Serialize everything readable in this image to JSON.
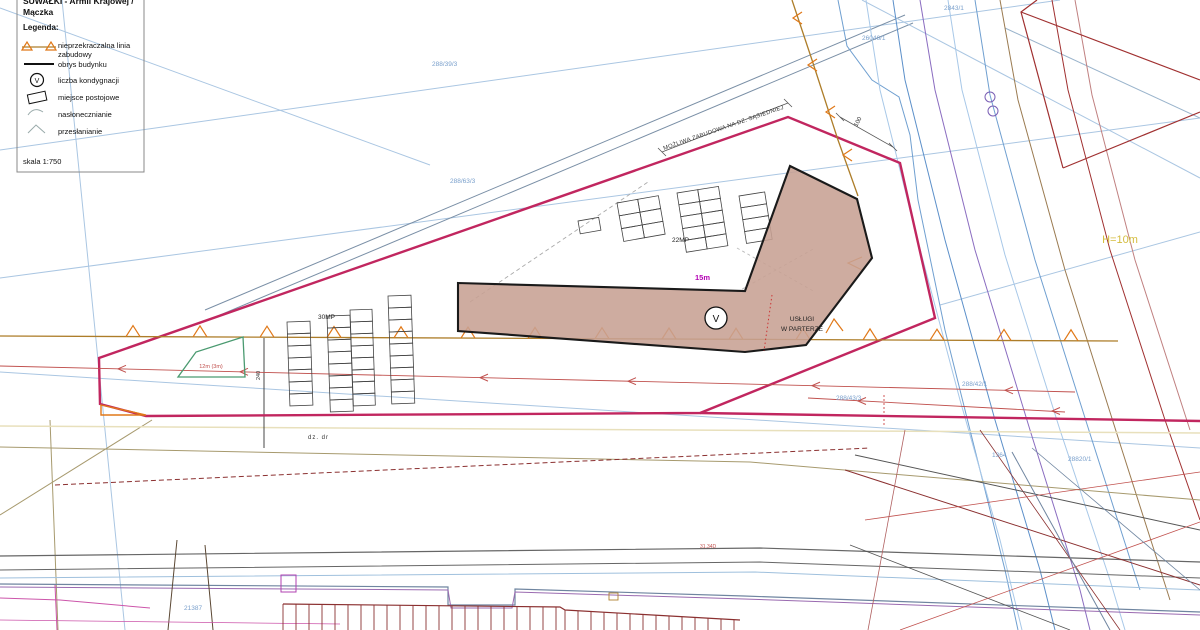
{
  "header": {
    "title_line1": "SUWAŁKI - Armii Krajowej /",
    "title_line2": "Mączka"
  },
  "legend": {
    "heading": "Legenda:",
    "storey_symbol": "V",
    "items": [
      {
        "symbol": "setback-line-icon",
        "label_line1": "nieprzekraczalna linia",
        "label_line2": "zabudowy"
      },
      {
        "symbol": "building-outline-icon",
        "label_line1": "obrys budynku",
        "label_line2": ""
      },
      {
        "symbol": "storey-count-icon",
        "label_line1": "liczba kondygnacji",
        "label_line2": ""
      },
      {
        "symbol": "parking-space-icon",
        "label_line1": "miejsce postojowe",
        "label_line2": ""
      },
      {
        "symbol": "sunlight-icon",
        "label_line1": "nasłonecznianie",
        "label_line2": ""
      },
      {
        "symbol": "shading-icon",
        "label_line1": "przesłanianie",
        "label_line2": ""
      }
    ],
    "scale": "skala 1:750"
  },
  "map": {
    "building": {
      "storeys": "V",
      "use_line1": "USŁUGI",
      "use_line2": "W PARTERZE"
    },
    "parking_labels": {
      "upper": "22MP",
      "left": "30MP"
    },
    "dimensions": {
      "setback_distance": "15m",
      "max_height": "H=10m",
      "dim_100": "100",
      "dim_240": "240",
      "green_area": "12m (3m)"
    },
    "annotations": {
      "adjacent_plot": "MOŻLIWA ZABUDOWA NA DZ. SĄSIEDNIEJ",
      "road_plot": "dz. dr",
      "spot_elevation": "31.34D"
    },
    "parcel_labels": [
      {
        "label": "288/39/3",
        "x": 432,
        "y": 66
      },
      {
        "label": "288/63/3",
        "x": 450,
        "y": 183
      },
      {
        "label": "26046/1",
        "x": 862,
        "y": 40
      },
      {
        "label": "2843/1",
        "x": 944,
        "y": 10
      },
      {
        "label": "288/43/3",
        "x": 836,
        "y": 400
      },
      {
        "label": "288/42/1",
        "x": 962,
        "y": 386
      },
      {
        "label": "21387",
        "x": 184,
        "y": 610
      },
      {
        "label": "1364",
        "x": 992,
        "y": 457
      },
      {
        "label": "28820/1",
        "x": 1068,
        "y": 461
      }
    ]
  },
  "colors": {
    "boundary": "#c1265f",
    "building_fill": "#c7a093",
    "setback_line": "#ad7d29",
    "triangle": "#e07818",
    "parcel_text": "#7aa0cc",
    "height_text": "#d4bc3e",
    "magenta_dim": "#b400b4"
  }
}
